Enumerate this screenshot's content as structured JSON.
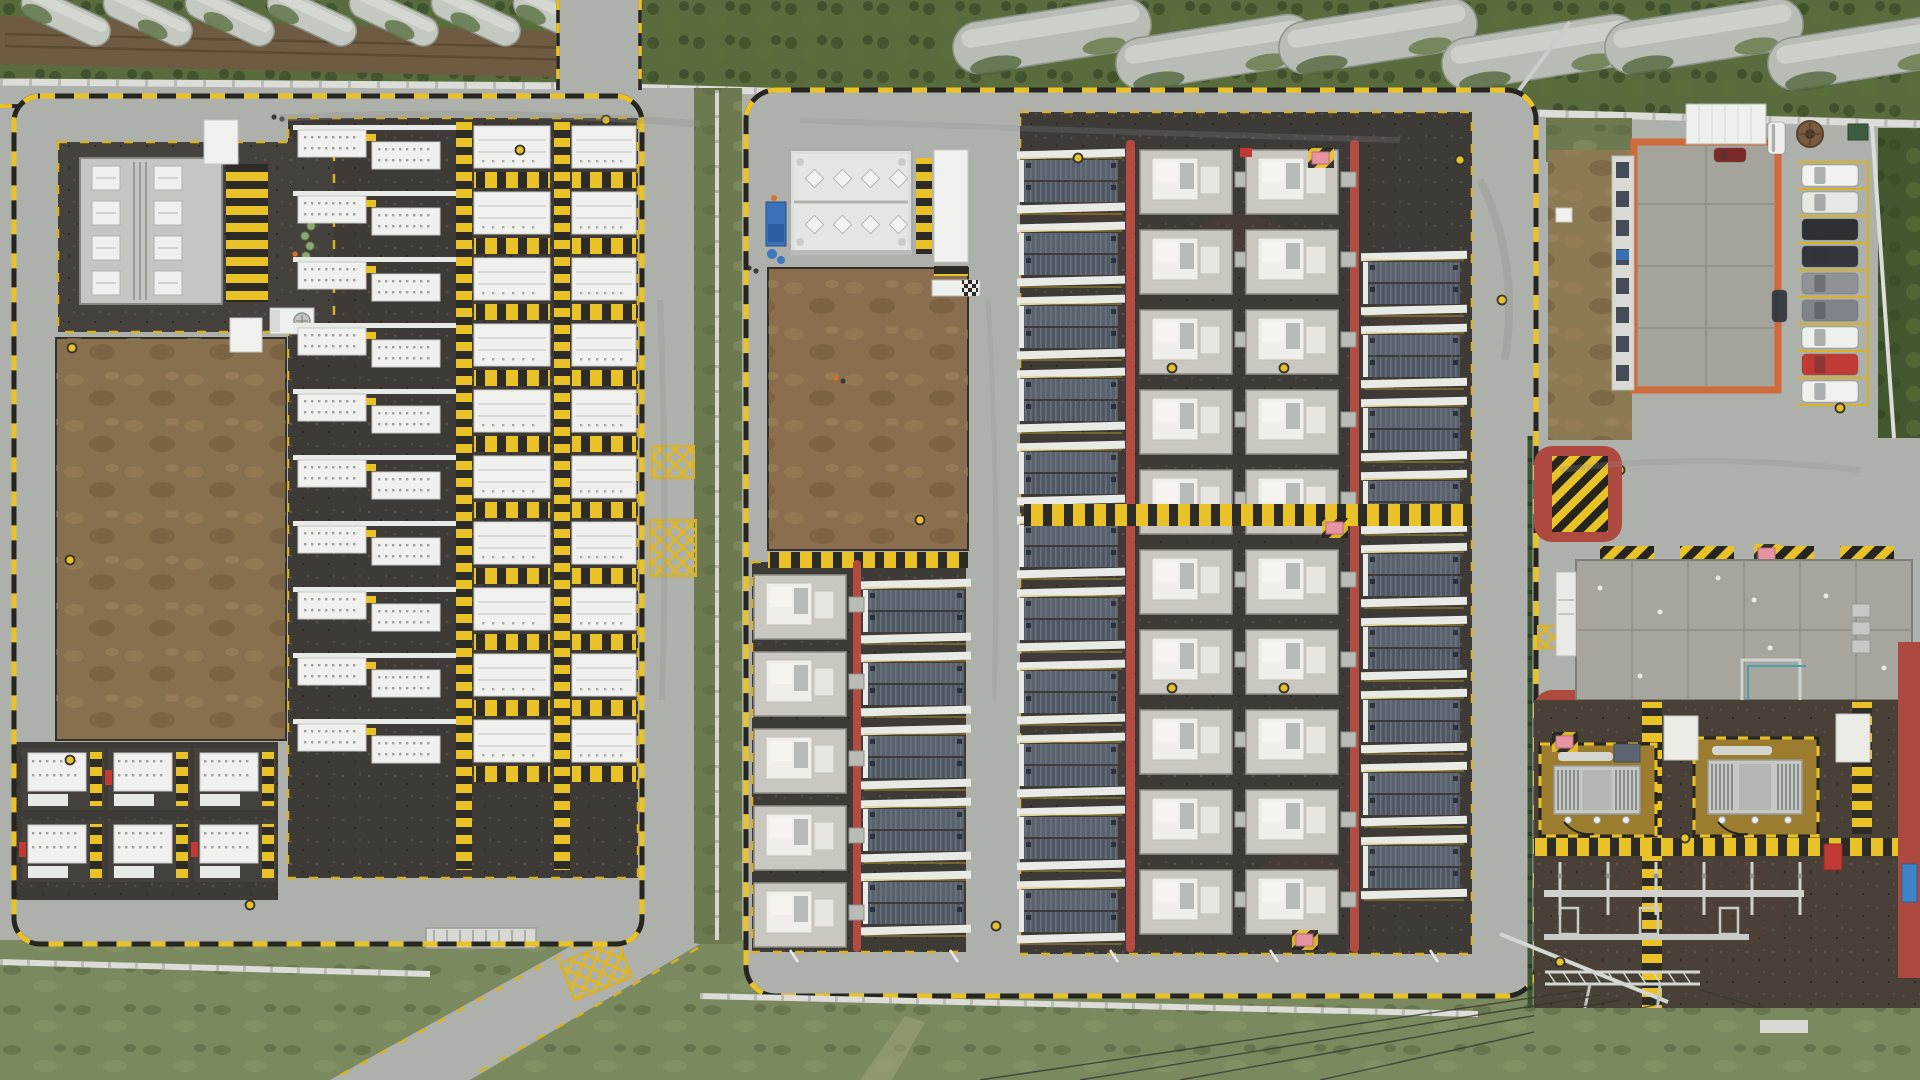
{
  "meta": {
    "title": "Aerial drone view of a battery energy storage power station",
    "type": "aerial-photograph",
    "no_visible_text": true
  },
  "scene": {
    "palette": {
      "road": "#aeb0ac",
      "road_tire": "#8e908c",
      "gravel": "#3e3a36",
      "gravel_pad": "#45413c",
      "gravel_red": "#574039",
      "field": "#8a6e4d",
      "field_left": "#87704e",
      "grass": "#7b8a5e",
      "grass_dark": "#6d7a50",
      "veg": "#5a6b3e",
      "veg_dark": "#44582f",
      "dirt": "#6f5b41",
      "lawn": "#8b7a52",
      "wall": "#dcddd9",
      "curb_black": "#26251f",
      "yellow": "#e9c227",
      "yellow_dim": "#d9b124",
      "red_lane": "#b44b41",
      "red_pave": "#ae4a40",
      "container_white": "#f0f1ee",
      "container_stroke": "#c6c8c4",
      "slab": "#e8eae6",
      "dark_container": "#59616c",
      "dark_container_alt": "#4f5762",
      "pad": "#c9c7c0",
      "pad_stroke": "#908e88",
      "unit_white": "#efeee9",
      "pink": "#e694a3",
      "fire_red": "#c23a34",
      "orange": "#cf6a3a",
      "roof_concrete": "#a4a39c",
      "roof_building2": "#a6a59e",
      "transformer_pad": "#9c7c2f",
      "transformer_body": "#c6c8c5",
      "steel": "#d0d2ce",
      "greenhouse": "#c3c8c1",
      "greenhouse_shade": "#8c948a",
      "mast": "#cbcdc9",
      "blue_lift": "#3a71b8",
      "blue_sign": "#3d85c8",
      "green_cylinder": "#8cab74",
      "wire": "#34372f",
      "platform": "#c5c6c2"
    },
    "top_strip": {
      "greenhouses_left": 7,
      "greenhouses_right": 6
    },
    "left_compound": {
      "transformer_bays": 8,
      "pair_rows": 10,
      "big_rows_mid": 10,
      "big_rows_right": 10,
      "cluster_cols": 3,
      "cluster_rows": 2,
      "green_cylinders": 5
    },
    "middle_compound": {
      "roof_vents": 8,
      "dark_groups_col_main": 11,
      "dark_groups_col_right": 9,
      "dark_groups_col_lower_left": 5,
      "white_units_col_a": 10,
      "white_units_col_b": 10,
      "white_units_col_lower_left": 5,
      "red_fire_lanes": 3
    },
    "right_area": {
      "facade_windows": 8,
      "parking_cars": [
        "#f2f3f0",
        "#e6e8e4",
        "#2e3134",
        "#33363a",
        "#8f9296",
        "#7f838a",
        "#eef0ec",
        "#c13b34",
        "#f0f1ee"
      ]
    },
    "substation": {
      "transformers": 2,
      "white_cabinets": 2,
      "hazard_pads_above_building": 4,
      "outgoing_wires": 5
    }
  }
}
